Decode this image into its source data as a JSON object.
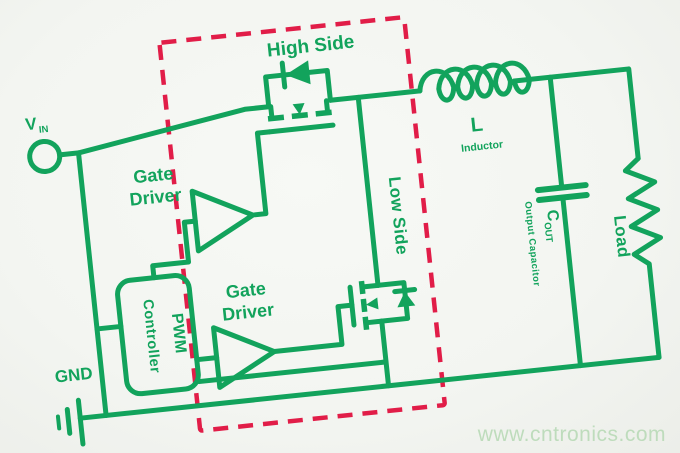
{
  "labels": {
    "vin_main": "V",
    "vin_sub": "IN",
    "gnd": "GND",
    "high_side": "High Side",
    "low_side": "Low Side",
    "gate_driver_top_line1": "Gate",
    "gate_driver_top_line2": "Driver",
    "gate_driver_bottom_line1": "Gate",
    "gate_driver_bottom_line2": "Driver",
    "pwm_line1": "PWM",
    "pwm_line2": "Controller",
    "inductor_ref": "L",
    "inductor_name": "Inductor",
    "cout_main": "C",
    "cout_sub": "OUT",
    "cout_name": "Output Capacitor",
    "load": "Load"
  },
  "watermark": "www.cntronics.com",
  "colors": {
    "wire": "#12a35c",
    "highlight_box": "#e11d48",
    "background": "#f3f5f1",
    "watermark": "#bedcbc"
  }
}
